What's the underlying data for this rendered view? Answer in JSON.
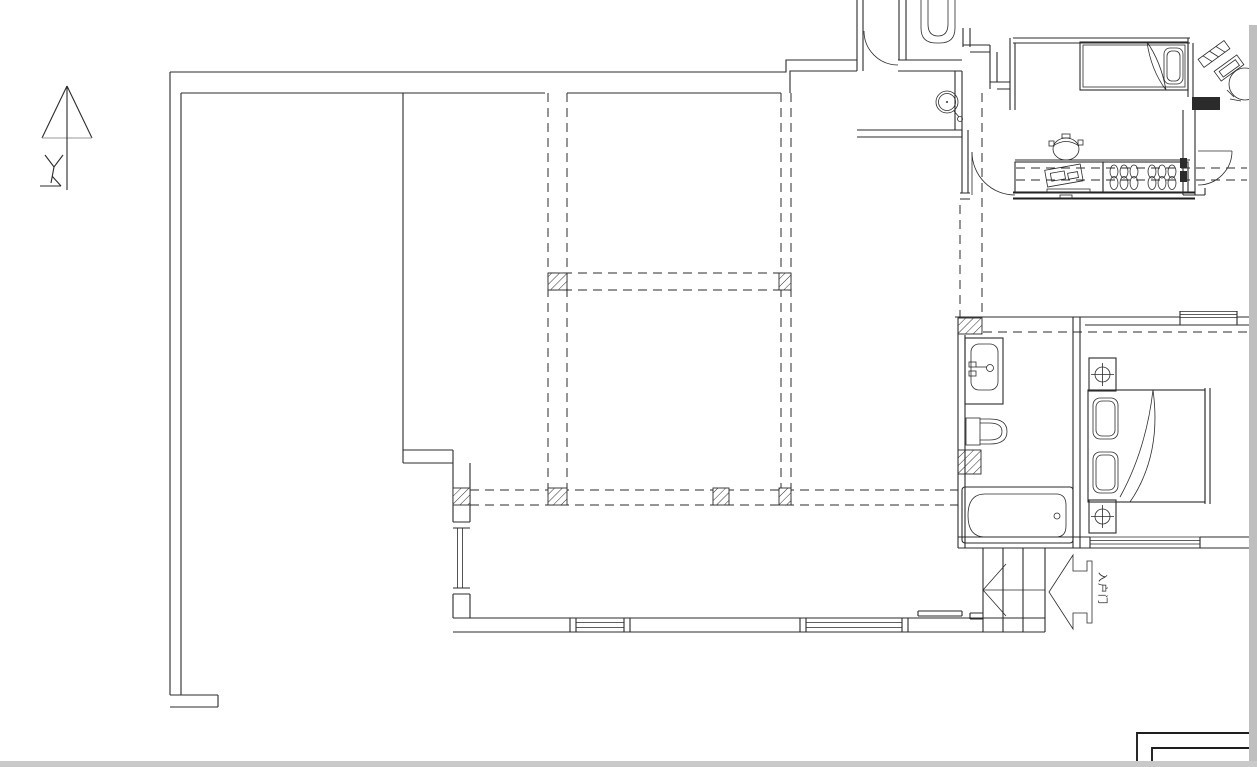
{
  "drawing": {
    "type": "architectural-floor-plan",
    "background_color": "#ffffff",
    "line_color": "#2b2b2b",
    "page_edge_color": "#bfbfbf",
    "entry_label": "入户门",
    "north_arrow": "top-left",
    "stair_direction": "left",
    "entry_direction": "left",
    "wall_styles": {
      "existing": "solid",
      "demolished": "dashed",
      "columns": "diagonal-hatch"
    },
    "fixtures": [
      "north-arrow",
      "entry-door",
      "wc-washbasin",
      "wc-toilet",
      "kitchen-counter",
      "rice-cooker",
      "counter-appliance",
      "dish-rack",
      "single-bed",
      "desk",
      "desk-chair",
      "kitchen-door",
      "vanity-sink",
      "toilet",
      "bathtub",
      "double-bed",
      "pillow",
      "nightstand-lamp",
      "bedroom-windows",
      "staircase-direction-arrow",
      "entry-direction-arrow",
      "dashed-demolition-walls",
      "hatched-columns",
      "drawing-frame-corner"
    ]
  }
}
